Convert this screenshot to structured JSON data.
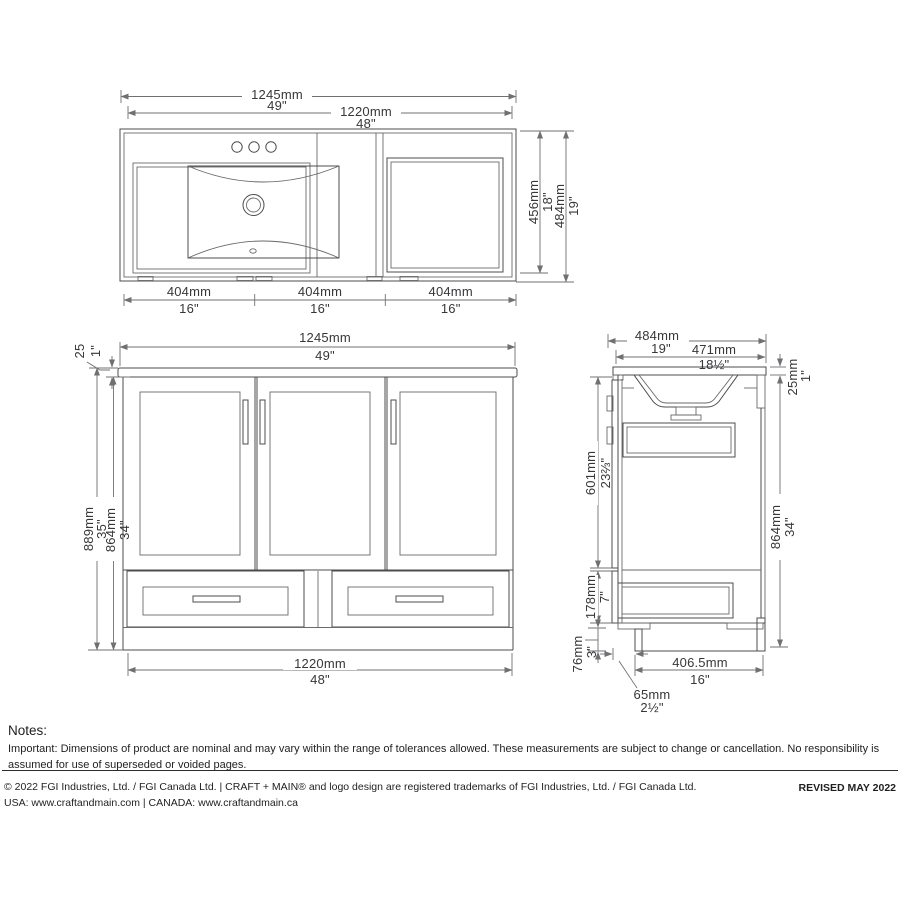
{
  "colors": {
    "line": "#4c4c4e",
    "dim_line": "#707073",
    "text": "#37373a",
    "background": "#ffffff"
  },
  "dims": {
    "top_overall": {
      "mm": "1245mm",
      "in": "49\""
    },
    "top_cab": {
      "mm": "1220mm",
      "in": "48\""
    },
    "top_depth_inner": {
      "mm": "456mm",
      "in": "18\""
    },
    "top_depth": {
      "mm": "484mm",
      "in": "19\""
    },
    "top_segments": [
      {
        "mm": "404mm",
        "in": "16\""
      },
      {
        "mm": "404mm",
        "in": "16\""
      },
      {
        "mm": "404mm",
        "in": "16\""
      }
    ],
    "front_overall": {
      "mm": "1245mm",
      "in": "49\""
    },
    "front_counter": {
      "mm": "25",
      "in": "1\""
    },
    "front_height": {
      "mm": "889mm",
      "in": "35\""
    },
    "front_cab_height": {
      "mm": "864mm",
      "in": "34\""
    },
    "front_cab_width": {
      "mm": "1220mm",
      "in": "48\""
    },
    "side_depth": {
      "mm": "484mm",
      "in": "19\""
    },
    "side_counter_depth": {
      "mm": "471mm",
      "in": "18½\""
    },
    "side_counter_thk": {
      "mm": "25mm",
      "in": "1\""
    },
    "side_door": {
      "mm": "601mm",
      "in": "23⅔\""
    },
    "side_cab_height": {
      "mm": "864mm",
      "in": "34\""
    },
    "side_drawer": {
      "mm": "178mm",
      "in": "7\""
    },
    "side_toekick": {
      "mm": "76mm",
      "in": "3\""
    },
    "side_base_depth": {
      "mm": "406.5mm",
      "in": "16\""
    },
    "side_front_gap": {
      "mm": "65mm",
      "in": "2½\""
    }
  },
  "notes": {
    "heading": "Notes:",
    "body": "Important: Dimensions of product are nominal and may vary within the range of tolerances allowed. These measurements are subject to change or cancellation. No responsibility is assumed for use of superseded or voided pages."
  },
  "footer": {
    "line1": "© 2022 FGI Industries, Ltd. / FGI Canada Ltd. | CRAFT + MAIN® and logo design are registered trademarks of FGI Industries, Ltd. / FGI Canada Ltd.",
    "line2": "USA: www.craftandmain.com | CANADA: www.craftandmain.ca",
    "revised": "REVISED MAY 2022"
  }
}
